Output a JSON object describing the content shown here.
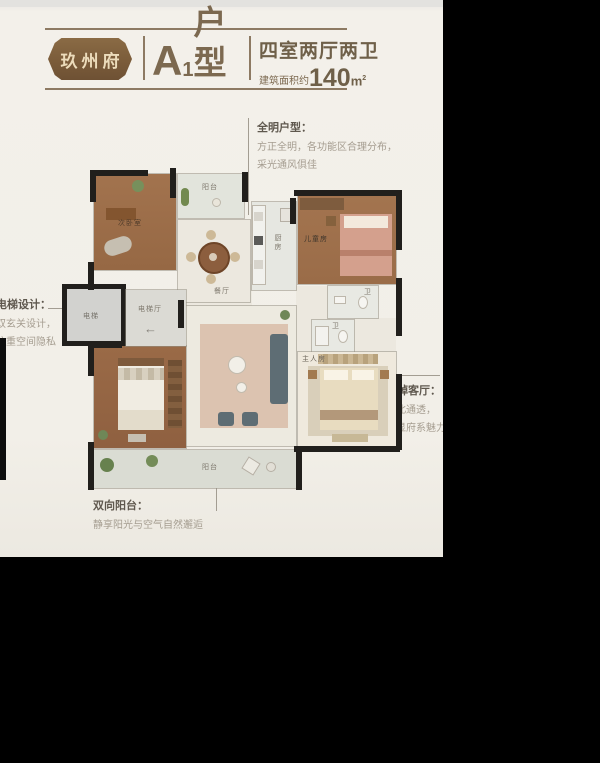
{
  "header": {
    "brand": "玖州府",
    "unit_letter": "A",
    "unit_number": "1",
    "unit_suffix": "户型",
    "spec": "四室两厅两卫",
    "area_prefix": "建筑面积约",
    "area_value": "140",
    "area_unit_base": "m",
    "area_unit_sup": "2"
  },
  "annotations": {
    "bright": {
      "title": "全明户型：",
      "line1": "方正全明，各功能区合理分布，",
      "line2": "采光通风俱佳"
    },
    "elevator": {
      "title": "电梯设计：",
      "line1": "双玄关设计，",
      "line2": "注重空间隐私"
    },
    "living": {
      "title": "阔绰客厅：",
      "line1": "南北通透，",
      "line2": "彰显府系魅力"
    },
    "balcony": {
      "title": "双向阳台：",
      "line1": "静享阳光与空气自然邂逅"
    }
  },
  "plan": {
    "rooms": {
      "study": "次卧室",
      "balcony_top": "阳台",
      "dining": "餐厅",
      "kitchen": "厨房",
      "kids": "儿童房",
      "bath1": "卫",
      "bath2": "卫",
      "master": "主人房",
      "balcony_bottom": "阳台",
      "elevator": "电梯",
      "elevator_hall": "电梯厅"
    },
    "entry_arrow": "←"
  },
  "colors": {
    "accent_brown": "#7c6950",
    "badge_brown": "#7b5c3a",
    "wall_black": "#211f1c",
    "paper_cream": "#f2efe8",
    "frame_black": "#000000"
  }
}
